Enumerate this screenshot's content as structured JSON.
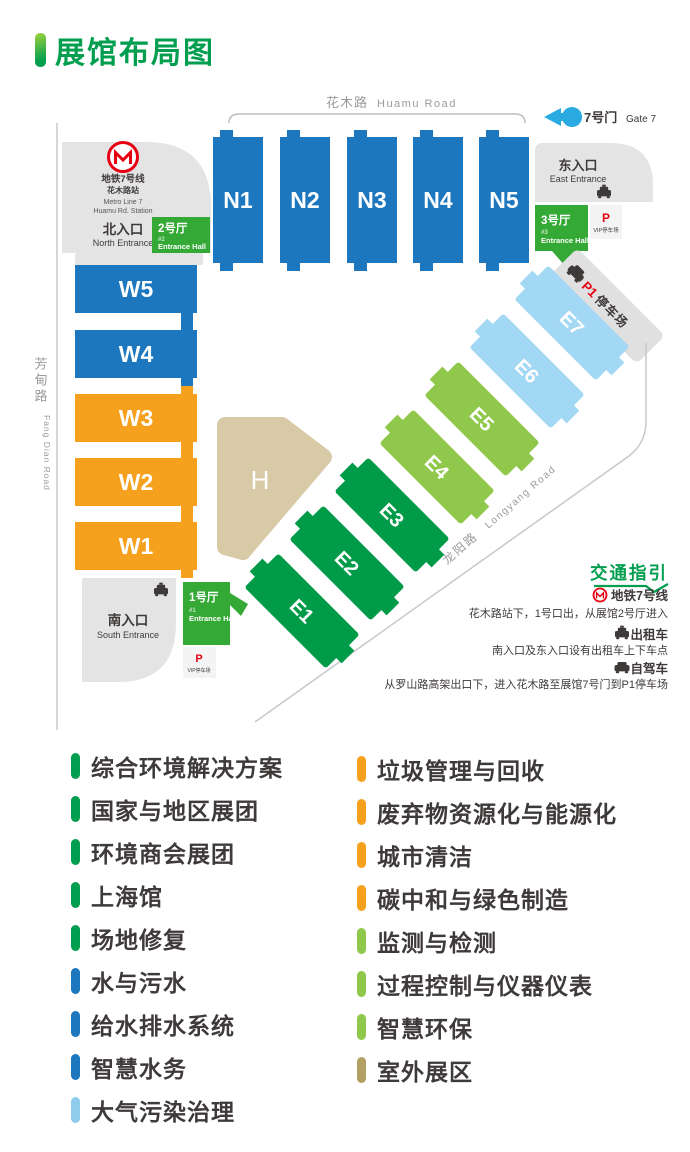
{
  "title": "展馆布局图",
  "palette": {
    "blue": "#1C77BE",
    "orange": "#F5A11D",
    "green": "#009B48",
    "lightGreen": "#8FC84A",
    "lightBlue": "#A3D8F4",
    "tan": "#D8CAA6",
    "entranceGreen": "#35A936",
    "accentGreen": "#009E4E",
    "red": "#E60012",
    "arrowBlue": "#29ABE2",
    "grayShape": "#E4E4E4",
    "darkText": "#3E3A39",
    "roadText": "#9B9B9B"
  },
  "map": {
    "huamu_road_cn": "花木路",
    "huamu_road_en": "Huamu Road",
    "fangdian_road_cn": "芳甸路",
    "fangdian_road_en": "Fang Dian Road",
    "longyang_road_cn": "龙阳路",
    "longyang_road_en": "Longyang Road",
    "gate7_cn": "7号门",
    "gate7_en": "Gate 7",
    "metro_station": {
      "l1": "地铁7号线",
      "l2": "花木路站",
      "l3": "Metro Line 7",
      "l4": "Huamu Rd. Station"
    },
    "north_entrance_cn": "北入口",
    "north_entrance_en": "North Entrance",
    "east_entrance_cn": "东入口",
    "east_entrance_en": "East Entrance",
    "south_entrance_cn": "南入口",
    "south_entrance_en": "South Entrance",
    "hall2_cn": "2号厅",
    "hall2_num": "#2",
    "hall2_en": "Entrance Hall",
    "hall3_cn": "3号厅",
    "hall3_num": "#3",
    "hall3_en": "Entrance Hall",
    "hall1_cn": "1号厅",
    "hall1_num": "#1",
    "hall1_en": "Entrance Hall",
    "vip_p": "P",
    "vip_label": "VIP停车场",
    "p1": "P1",
    "p1_label": "停车场",
    "halls": {
      "n": [
        "N1",
        "N2",
        "N3",
        "N4",
        "N5"
      ],
      "w": [
        "W5",
        "W4",
        "W3",
        "W2",
        "W1"
      ],
      "e": [
        "E1",
        "E2",
        "E3",
        "E4",
        "E5",
        "E6",
        "E7"
      ],
      "h": "H"
    }
  },
  "traffic": {
    "title": "交通指引",
    "metro_label": "地铁7号线",
    "metro_desc": "花木路站下，1号口出，从展馆2号厅进入",
    "taxi_label": "出租车",
    "taxi_desc": "南入口及东入口设有出租车上下车点",
    "car_label": "自驾车",
    "car_desc": "从罗山路高架出口下，进入花木路至展馆7号门到P1停车场"
  },
  "legend": {
    "left": [
      {
        "label": "综合环境解决方案",
        "color": "#009E4E"
      },
      {
        "label": "国家与地区展团",
        "color": "#009E4E"
      },
      {
        "label": "环境商会展团",
        "color": "#009E4E"
      },
      {
        "label": "上海馆",
        "color": "#009E4E"
      },
      {
        "label": "场地修复",
        "color": "#009E4E"
      },
      {
        "label": "水与污水",
        "color": "#1C77BE"
      },
      {
        "label": "给水排水系统",
        "color": "#1C77BE"
      },
      {
        "label": "智慧水务",
        "color": "#1C77BE"
      },
      {
        "label": "大气污染治理",
        "color": "#8FCBEC"
      }
    ],
    "right": [
      {
        "label": "垃圾管理与回收",
        "color": "#F5A11D"
      },
      {
        "label": "废弃物资源化与能源化",
        "color": "#F5A11D"
      },
      {
        "label": "城市清洁",
        "color": "#F5A11D"
      },
      {
        "label": "碳中和与绿色制造",
        "color": "#F5A11D"
      },
      {
        "label": "监测与检测",
        "color": "#8FC84A"
      },
      {
        "label": "过程控制与仪器仪表",
        "color": "#8FC84A"
      },
      {
        "label": "智慧环保",
        "color": "#8FC84A"
      },
      {
        "label": "室外展区",
        "color": "#B2A065"
      }
    ]
  }
}
